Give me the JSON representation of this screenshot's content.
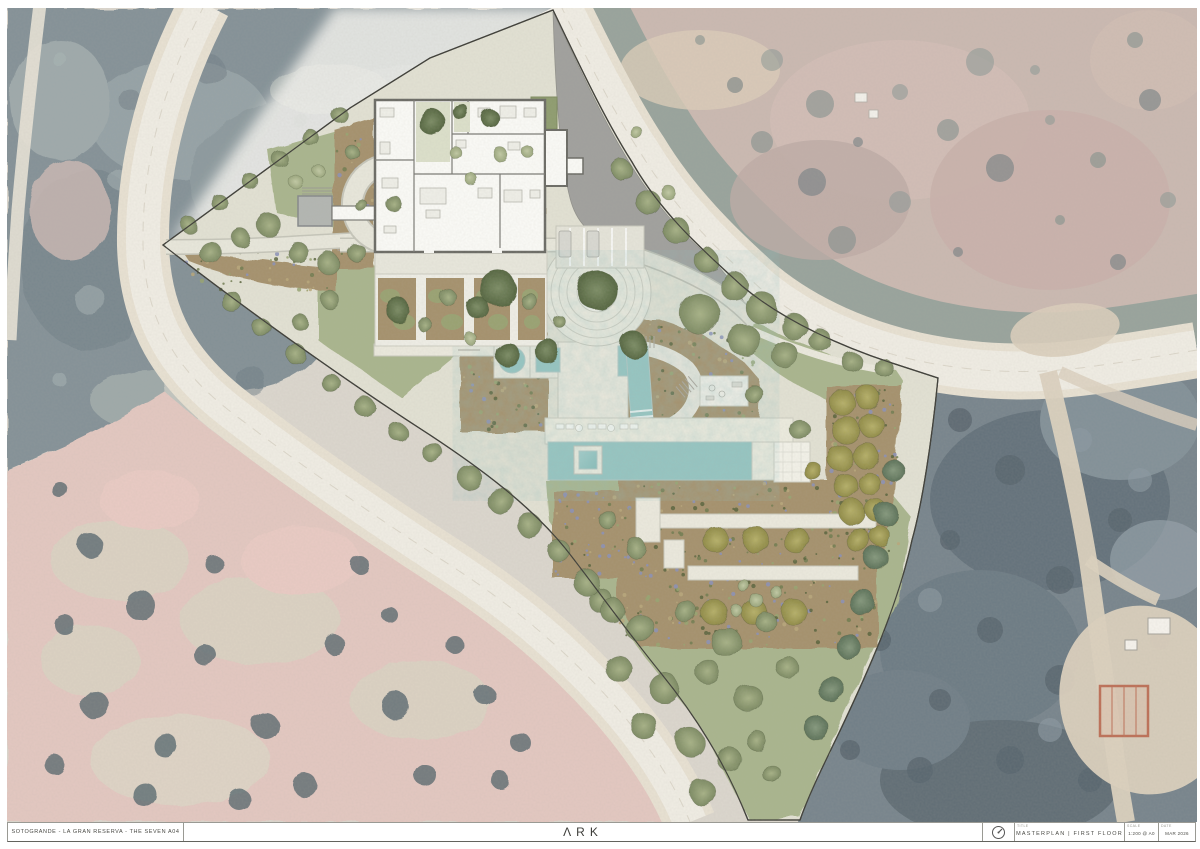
{
  "title_block": {
    "project_title": "SOTOGRANDE - LA GRAN RESERVA - THE SEVEN A04",
    "logo_text": "ΛRK",
    "cells": {
      "drawing": {
        "label": "TITLE",
        "value": "MASTERPLAN | FIRST FLOOR"
      },
      "scale": {
        "label": "SCALE",
        "value": "1:200 @ A0"
      },
      "date": {
        "label": "DATE",
        "value": "MAR 2026"
      }
    },
    "north_icon": "compass-north-icon"
  },
  "plan": {
    "feature_colors": {
      "water": "#96c6c2",
      "lawn": "#a9b58d",
      "planting_bed": "#a5916c",
      "paving": "#eceade",
      "adjacent_plot": "#9e9e9c",
      "road": "#f0ece2",
      "aerial_forest": "#76858c",
      "aerial_field": "#e1c2ba"
    }
  }
}
